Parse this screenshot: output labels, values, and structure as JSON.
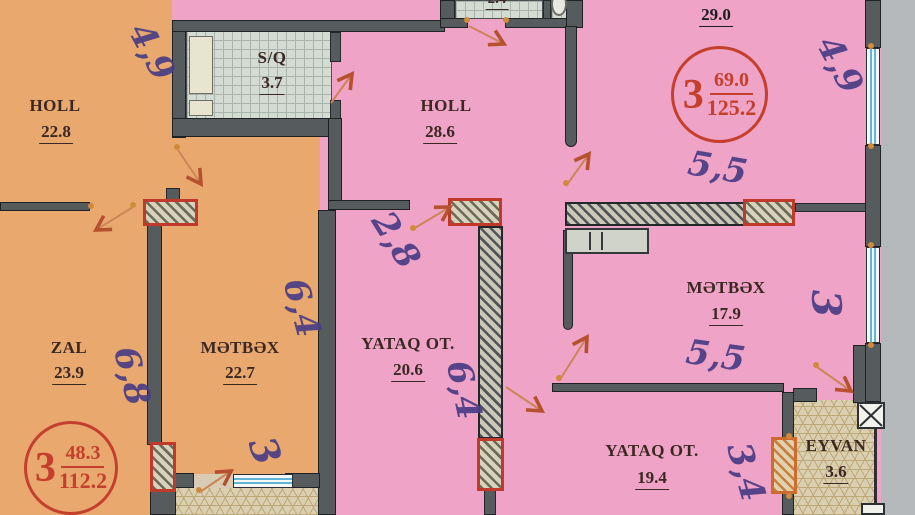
{
  "plan": {
    "rooms": {
      "holl_left": {
        "name": "HOLL",
        "area": "22.8"
      },
      "sq": {
        "name": "S/Q",
        "area": "3.7"
      },
      "zal": {
        "name": "ZAL",
        "area": "23.9"
      },
      "metbex_left": {
        "name": "MƏTBƏX",
        "area": "22.7"
      },
      "holl_right": {
        "name": "HOLL",
        "area": "28.6"
      },
      "yataq_20": {
        "name": "YATAQ OT.",
        "area": "20.6"
      },
      "metbex_right": {
        "name": "MƏTBƏX",
        "area": "17.9"
      },
      "yataq_19": {
        "name": "YATAQ OT.",
        "area": "19.4"
      },
      "eyvan": {
        "name": "EYVAN",
        "area": "3.6"
      },
      "wc_top": {
        "name": "",
        "area": "2.4"
      },
      "open_area": {
        "name": "",
        "area": "29.0"
      }
    },
    "stamps": {
      "left": {
        "room_count": "3",
        "net_area": "48.3",
        "total_area": "112.2"
      },
      "right": {
        "room_count": "3",
        "net_area": "69.0",
        "total_area": "125.2"
      }
    },
    "handwritten_dimensions": {
      "d1": "4,9",
      "d2": "2,8",
      "d3": "6,4",
      "d4": "6,8",
      "d5": "3",
      "d6": "6,4",
      "d7": "5,5",
      "d8": "5,5",
      "d9": "3",
      "d10": "3,4",
      "d11": "4,9"
    },
    "colors": {
      "left_apartment": "#e9a86e",
      "right_apartment": "#efa3c6",
      "wall": "#565b5e",
      "red_marker": "#c5402c",
      "handwriting": "#4a3d85",
      "outside": "#b6b9bb"
    }
  }
}
